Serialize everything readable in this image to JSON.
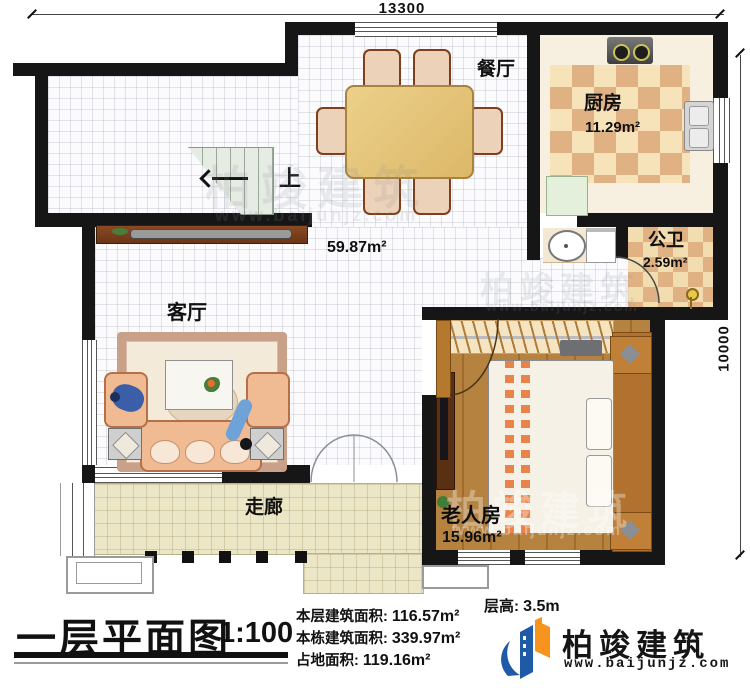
{
  "dimensions": {
    "width_label": "13300",
    "height_label": "10000"
  },
  "rooms": {
    "dining": {
      "label": "餐厅"
    },
    "kitchen": {
      "label": "厨房",
      "area": "11.29m²"
    },
    "bathroom": {
      "label": "公卫",
      "area": "2.59m²"
    },
    "living": {
      "label": "客厅"
    },
    "bedroom": {
      "label": "老人房",
      "area": "15.96m²"
    },
    "corridor": {
      "label": "走廊"
    },
    "hall": {
      "area": "59.87m²"
    },
    "stairs": {
      "label": "上"
    }
  },
  "title_block": {
    "title": "一层平面图",
    "scale": "1:100",
    "stats": [
      {
        "label": "本层建筑面积:",
        "value": "116.57m²"
      },
      {
        "label": "本栋建筑面积:",
        "value": "339.97m²"
      },
      {
        "label": "占地面积:",
        "value": "119.16m²"
      }
    ],
    "floor_height": {
      "label": "层高:",
      "value": "3.5m"
    }
  },
  "branding": {
    "name": "柏竣建筑",
    "website": "www.baijunjz.com"
  },
  "colors": {
    "wall": "#161616",
    "kitchen_tile_dark": "#dfb183",
    "kitchen_tile_light": "#f6e3ba",
    "corridor_floor": "#eae6c6",
    "bedroom_wood": "#b5823f",
    "logo_blue": "#1f5aa6",
    "logo_orange": "#f7941d"
  }
}
